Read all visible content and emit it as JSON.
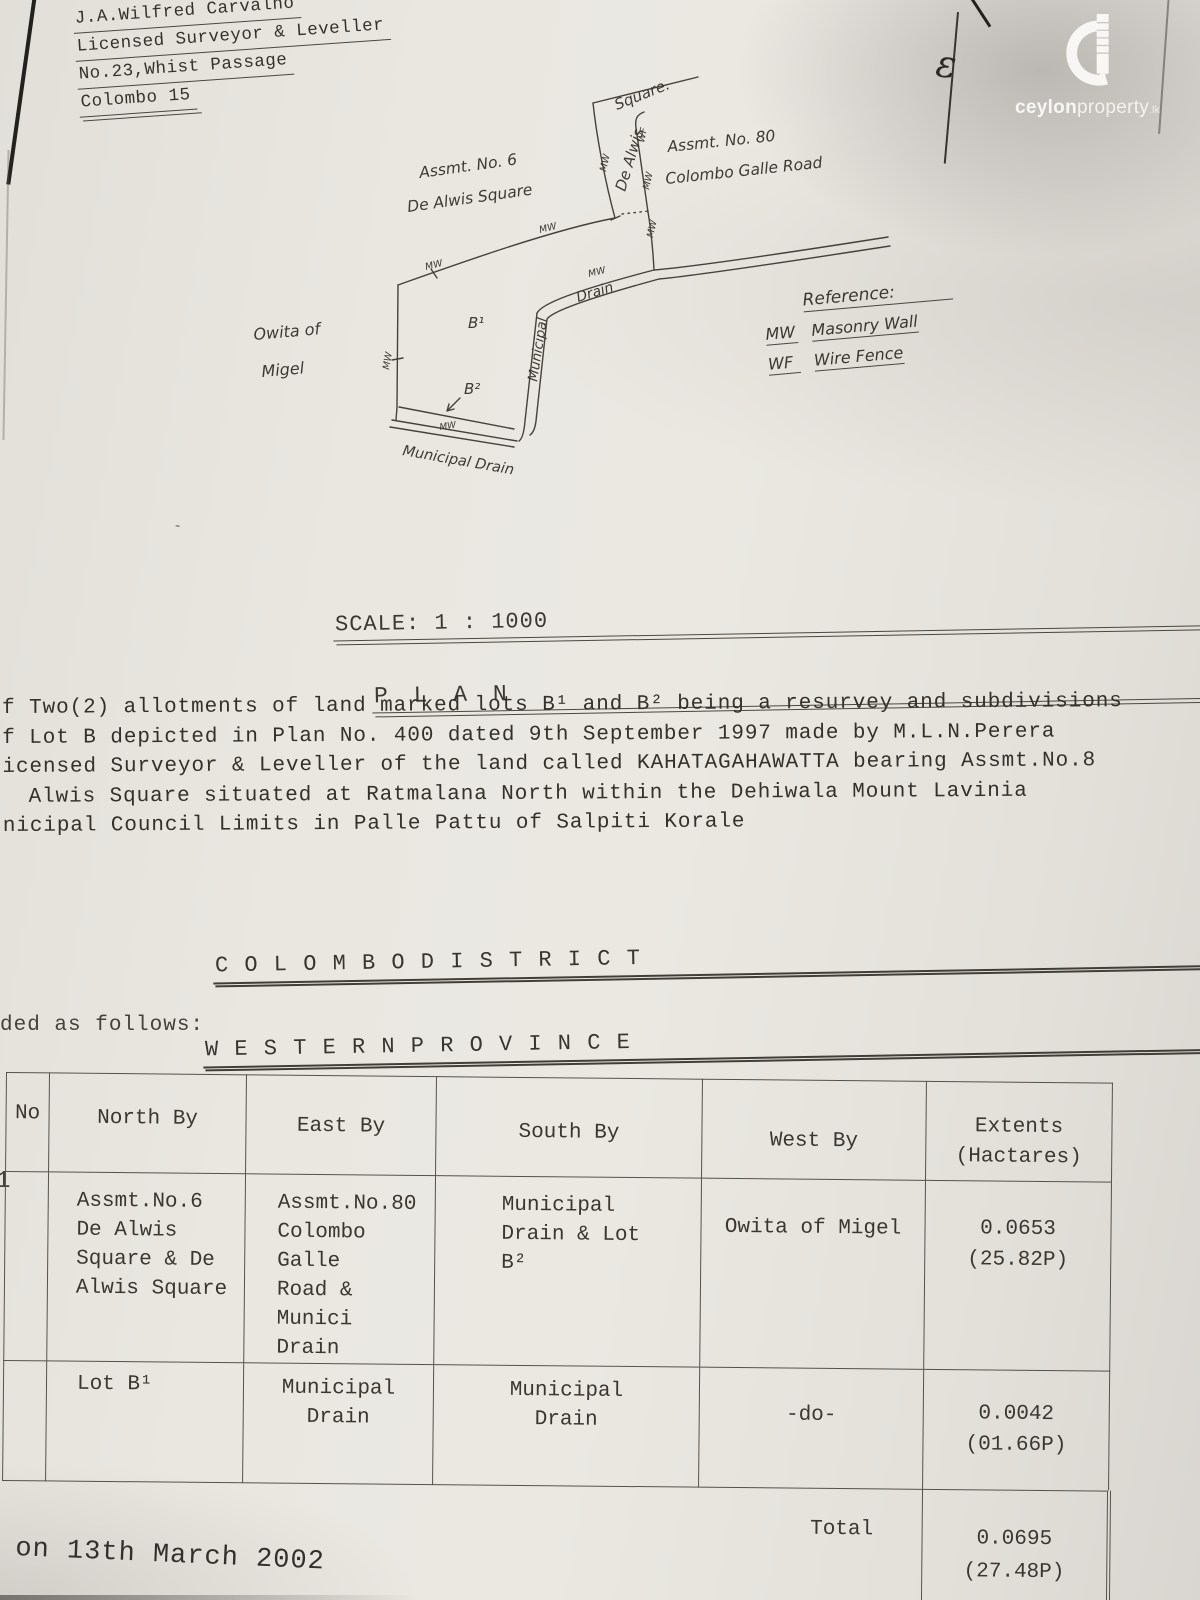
{
  "surveyor": {
    "line1": "J.A.Wilfred Carvalho",
    "line2": "Licensed Surveyor & Leveller",
    "line3": "No.23,Whist Passage",
    "line4": "Colombo 15"
  },
  "compass": {
    "mark": "ε"
  },
  "logo": {
    "bold": "ceylon",
    "light": "property",
    "tld": ".lk"
  },
  "plan": {
    "scale": "SCALE: 1 : 1000",
    "title": "P L A N",
    "labels": {
      "square": "Square.",
      "road_name": "De Alwis",
      "assmt6_1": "Assmt. No. 6",
      "assmt6_2": "De Alwis Square",
      "assmt80_1": "Assmt. No. 80",
      "assmt80_2": "Colombo Galle Road",
      "owita_1": "Owita of",
      "owita_2": "Migel",
      "lot_b1": "B¹",
      "lot_b2": "B²",
      "municipal": "Municipal",
      "drain": "Drain",
      "municipal_drain": "Municipal Drain",
      "mw": "MW",
      "wf": "WF"
    },
    "reference": {
      "title": "Reference:",
      "mw_abbr": "MW",
      "mw_label": "Masonry Wall",
      "wf_abbr": "WF",
      "wf_label": "Wire Fence"
    }
  },
  "description": {
    "line1": "f Two(2) allotments of land marked lots B¹ and B² being a resurvey and subdivisions",
    "line2": "f Lot B depicted in Plan No. 400 dated 9th September 1997 made by M.L.N.Perera",
    "line3": "icensed Surveyor & Leveller of the land called KAHATAGAHAWATTA bearing Assmt.No.8",
    "line4": "Alwis Square situated at Ratmalana North within the Dehiwala Mount Lavinia",
    "line5": "nicipal Council Limits in Palle Pattu of Salpiti Korale"
  },
  "headings": {
    "district": "C O L O M B O   D I S T R I C T",
    "province": "W E S T E R N     P R O V I N C E",
    "bounded": "ded as follows:"
  },
  "table": {
    "headers": {
      "no": "No",
      "north": "North By",
      "east": "East By",
      "south": "South By",
      "west": "West By",
      "extents_1": "Extents",
      "extents_2": "(Hactares)"
    },
    "rows": [
      {
        "no": "1",
        "north": [
          "Assmt.No.6",
          "De Alwis",
          "Square & De",
          "Alwis Square"
        ],
        "east": [
          "Assmt.No.80",
          "Colombo Galle",
          "Road & Munici",
          "Drain"
        ],
        "south": [
          "Municipal",
          "Drain & Lot",
          "B²"
        ],
        "west": [
          "Owita of Migel"
        ],
        "extent": [
          "0.0653",
          "(25.82P)"
        ]
      },
      {
        "no": "",
        "north": [
          "Lot B¹"
        ],
        "east": [
          "Municipal",
          "Drain"
        ],
        "south": [
          "Municipal",
          "Drain"
        ],
        "west": [
          "-do-"
        ],
        "extent": [
          "0.0042",
          "(01.66P)"
        ]
      }
    ],
    "total_label": "Total",
    "total_extent": [
      "0.0695",
      "(27.48P)"
    ]
  },
  "footer": {
    "date": "on 13th March 2002"
  }
}
